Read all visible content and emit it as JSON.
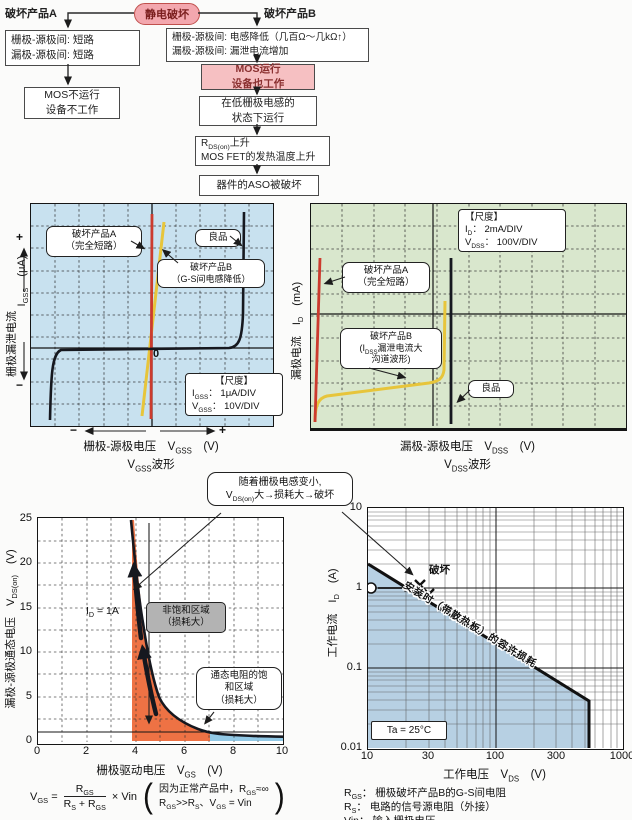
{
  "colors": {
    "pink_node": "#f3a7ae",
    "pink_box": "#f6c0c2",
    "gss_bg": "#c8e1ef",
    "dss_bg": "#d9e7cd",
    "red_trace": "#cc3b2e",
    "yellow_trace": "#e7c53b",
    "black_trace": "#16181f",
    "unsat_region": "#ee7244",
    "sat_region": "#92c9e6",
    "aso_region": "#b7d0e3",
    "gray_box": "#b3b3b3"
  },
  "flowchart": {
    "root": "静电破坏",
    "branch_a_label": "破坏产品A",
    "branch_b_label": "破坏产品B",
    "a_box1": [
      "栅极-源极间: 短路",
      "漏极-源极间: 短路"
    ],
    "a_box2": [
      "MOS不运行",
      "设备不工作"
    ],
    "b_box1": [
      "栅极-源极间: 电感降低（几百Ω～几kΩ↑）",
      "漏极-源极间: 漏泄电流增加"
    ],
    "b_box2": [
      "MOS运行",
      "设备也工作"
    ],
    "b_box3": [
      "在低栅极电感的",
      "状态下运行"
    ],
    "b_box4": [
      "R_{DS(on)}上升",
      "MOS FET的发热温度上升"
    ],
    "b_box5": "器件的ASO被破坏"
  },
  "gss": {
    "ylabel_cn": "栅极漏泄电流",
    "ylabel_sym": "I_{GSS}　(μA)",
    "plus": "+",
    "minus": "−",
    "xminus": "−",
    "xplus": "+",
    "zero": "0",
    "ann_a": [
      "破坏产品A",
      "（完全短路）"
    ],
    "ann_b": [
      "破坏产品B",
      "（G-S间电感降低）"
    ],
    "good": "良品",
    "scale": [
      "【尺度】",
      "I_{GSS}： 1μA/DIV",
      "V_{GSS}： 10V/DIV"
    ],
    "xlabel": "栅极-源极电压　V_{GSS}　(V)",
    "xwave": "V_{GSS}波形"
  },
  "dss": {
    "ylabel": "漏极电流　I_{D}　(mA)",
    "scale": [
      "【尺度】",
      "I_{D}： 2mA/DIV",
      "V_{DSS}： 100V/DIV"
    ],
    "ann_a": [
      "破坏产品A",
      "（完全短路）"
    ],
    "ann_b": [
      "破坏产品B",
      "(I_{DSS}漏泄电流大",
      "沟道波形)"
    ],
    "good": "良品",
    "xlabel": "漏极-源极电压　V_{DSS}　(V)",
    "xwave": "V_{DSS}波形"
  },
  "callout": [
    "随着栅极电感变小,",
    "V_{DS(on)}大→损耗大→破坏"
  ],
  "vdson": {
    "ylabel": "漏极-源极通态电压　V_{DS(on)}　(V)",
    "xlabel": "栅极驱动电压　V_{GS}　(V)",
    "yticks": [
      "25",
      "20",
      "15",
      "10",
      "5",
      "0"
    ],
    "xticks": [
      "0",
      "2",
      "4",
      "6",
      "8",
      "10"
    ],
    "id_label": "I_{D} = 1A",
    "region1": [
      "非饱和区域",
      "（损耗大）"
    ],
    "region2": [
      "通态电阻的饱",
      "和区域",
      "（损耗大）"
    ]
  },
  "aso": {
    "ylabel": "工作电流　I_{D}　(A)",
    "xlabel": "工作电压　V_{DS}　(V)",
    "yticks": [
      "10",
      "1",
      "0.1",
      "0.01"
    ],
    "xticks": [
      "10",
      "30",
      "100",
      "300",
      "1000"
    ],
    "diag_label": "安装时（带散热板）的容许损耗",
    "break_label": "破坏",
    "ta": "Ta = 25°C"
  },
  "formula": {
    "lhs": "V_{GS} =",
    "num": "R_{GS}",
    "den": "R_{S} + R_{GS}",
    "rhs": "× Vin",
    "note1": "因为正常产品中，R_{GS}≈∞",
    "note2": "R_{GS}>>R_{S}、V_{GS} = Vin"
  },
  "legend": [
    "R_{GS}： 栅极破坏产品B的G-S间电阻",
    "R_{S}： 电路的信号源电阻（外接）",
    "Vin： 输入栅极电压"
  ],
  "chart_data": [
    {
      "type": "line",
      "title": "VGSS波形（栅极漏泄电流-栅极源极电压 示波图）",
      "xlabel": "栅极-源极电压 VGSS (V)",
      "ylabel": "栅极漏泄电流 IGSS (μA)",
      "x_scale": "10V/DIV",
      "y_scale": "1μA/DIV",
      "grid": "10x10 DIV dashed",
      "series": [
        {
          "name": "破坏产品A（完全短路）",
          "color": "#cc3b2e",
          "points_v_ua": [
            [
              0,
              -9
            ],
            [
              0,
              9
            ]
          ]
        },
        {
          "name": "破坏产品B（G-S间电感降低）",
          "color": "#e7c53b",
          "points_v_ua": [
            [
              -4,
              -9
            ],
            [
              4,
              9
            ]
          ]
        },
        {
          "name": "良品",
          "color": "#16181f",
          "points_v_ua": [
            [
              -42,
              -9
            ],
            [
              -40,
              -0.1
            ],
            [
              40,
              0.1
            ],
            [
              42,
              9
            ]
          ]
        }
      ]
    },
    {
      "type": "line",
      "title": "VDSS波形（漏极电流-漏极源极电压 示波图）",
      "xlabel": "漏极-源极电压 VDSS (V)",
      "ylabel": "漏极电流 ID (mA)",
      "x_scale": "100V/DIV",
      "y_scale": "2mA/DIV",
      "grid": "10x10 DIV dashed",
      "series": [
        {
          "name": "破坏产品A（完全短路）",
          "color": "#cc3b2e",
          "points_v_ma": [
            [
              5,
              15
            ],
            [
              0,
              0.5
            ]
          ]
        },
        {
          "name": "破坏产品B（IDSS漏泄电流大, 沟道波形）",
          "color": "#e7c53b",
          "points_v_ma": [
            [
              0,
              0.3
            ],
            [
              20,
              2.5
            ],
            [
              380,
              4
            ],
            [
              420,
              11
            ]
          ]
        },
        {
          "name": "良品",
          "color": "#16181f",
          "points_v_ma": [
            [
              420,
              0
            ],
            [
              420,
              15
            ]
          ]
        }
      ]
    },
    {
      "type": "line",
      "title": "VDS(on) vs VGS (ID = 1A)",
      "xlabel": "栅极驱动电压 VGS (V)",
      "ylabel": "漏极-源极通态电压 VDS(on) (V)",
      "xlim": [
        0,
        10
      ],
      "ylim": [
        0,
        25
      ],
      "grid": "dashed, x every 1V, y every 2.5V",
      "series": [
        {
          "name": "VDS(on)",
          "color": "#16181f",
          "points": [
            [
              3.9,
              25
            ],
            [
              4,
              21
            ],
            [
              4.3,
              12
            ],
            [
              4.5,
              8.5
            ],
            [
              5,
              4.2
            ],
            [
              5.5,
              2.6
            ],
            [
              6,
              1.8
            ],
            [
              6.5,
              1.3
            ],
            [
              7,
              0.95
            ],
            [
              8,
              0.7
            ],
            [
              9,
              0.58
            ],
            [
              10,
              0.5
            ]
          ]
        }
      ],
      "reference_line_y": 1,
      "regions": [
        {
          "name": "非饱和区域（损耗大）",
          "x_range": [
            3.9,
            7
          ],
          "color": "#ee7244"
        },
        {
          "name": "通态电阻的饱和区域（损耗大）",
          "x_range": [
            7,
            10
          ],
          "color": "#92c9e6"
        }
      ]
    },
    {
      "type": "line",
      "title": "容许损耗线（ASO）",
      "xlabel": "工作电压 VDS (V)",
      "ylabel": "工作电流 ID (A)",
      "xscale": "log",
      "yscale": "log",
      "xlim": [
        10,
        1000
      ],
      "ylim": [
        0.01,
        10
      ],
      "condition": "Ta = 25°C",
      "series": [
        {
          "name": "安装时（带散热板）的容许损耗",
          "color": "#16181f",
          "points": [
            [
              10,
              2
            ],
            [
              500,
              0.04
            ],
            [
              500,
              0.01
            ]
          ]
        }
      ],
      "markers": [
        {
          "name": "工作点",
          "shape": "open-circle",
          "point": [
            10,
            1
          ]
        },
        {
          "name": "破坏",
          "shape": "x",
          "points": [
            [
              28,
              1.1
            ],
            [
              32,
              0.9
            ]
          ]
        }
      ]
    }
  ]
}
